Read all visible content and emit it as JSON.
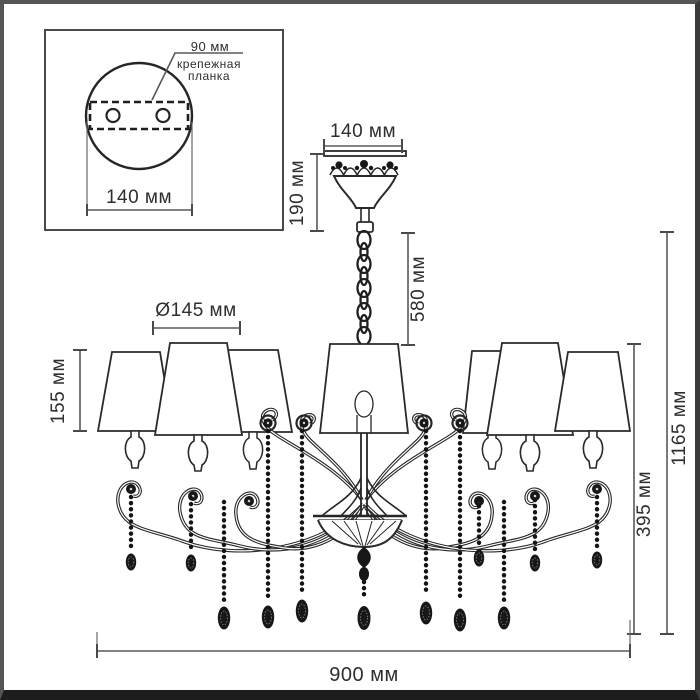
{
  "diagram_type": "chandelier-dimension-drawing",
  "units": "мм",
  "inset": {
    "plate_width_label": "90 мм",
    "bracket_label_line1": "крепежная",
    "bracket_label_line2": "планка",
    "base_diameter_label": "140 мм"
  },
  "dimensions": {
    "canopy_diameter": "140 мм",
    "canopy_height": "190 мм",
    "chain_length": "580 мм",
    "shade_diameter": "Ø145 мм",
    "shade_height": "155 мм",
    "total_height": "1165 мм",
    "body_height": "395 мм",
    "total_width": "900 мм"
  },
  "colors": {
    "background": "#ffffff",
    "linework": "#262626",
    "dimension_lines": "#585858",
    "text": "#2e2e2e",
    "frame": "#1d1d1d"
  }
}
